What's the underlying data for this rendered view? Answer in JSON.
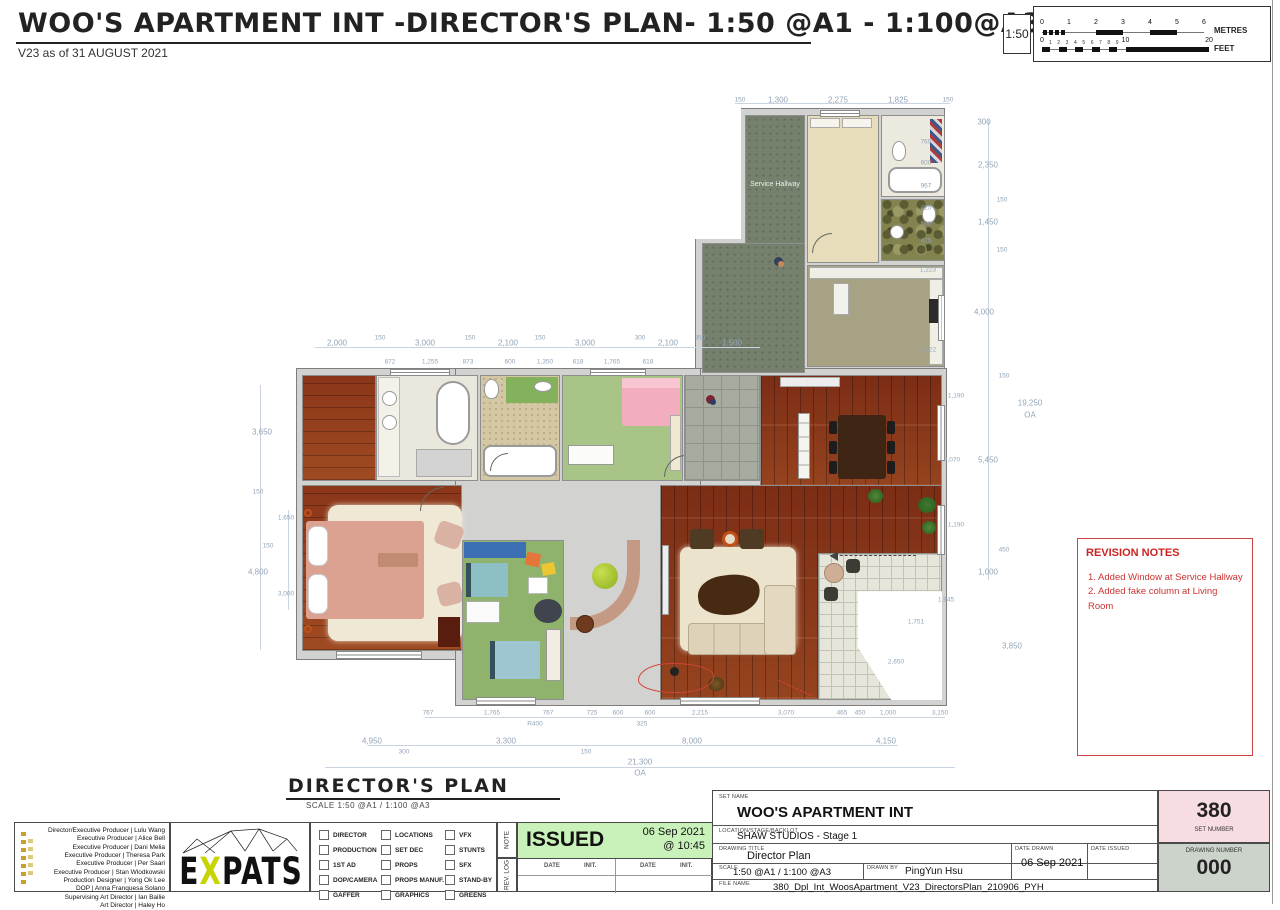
{
  "colors": {
    "revision_red": "#cc3333",
    "issued_green": "#c9f2ba",
    "set_number_pink": "#f7dce2",
    "drawing_number_gray": "#ccd3cb",
    "dim_blue": "#93a4b6",
    "wood_floor": "#7c2d15",
    "logo_x_green": "#c8d400"
  },
  "header": {
    "title": "WOO'S APARTMENT INT -DIRECTOR'S PLAN- 1:50 @A1 - 1:100@A3",
    "version": "V23 as of 31 AUGUST 2021"
  },
  "scalebar": {
    "ratio": "1:50",
    "metres_label": "METRES",
    "feet_label": "FEET",
    "metre_ticks": [
      "0",
      "1",
      "2",
      "3",
      "4",
      "5",
      "6"
    ],
    "feet_major_ticks": [
      "0",
      "10",
      "20"
    ],
    "feet_minor_ticks": [
      "1",
      "2",
      "3",
      "4",
      "5",
      "6",
      "7",
      "8",
      "9"
    ]
  },
  "plan": {
    "rooms": {
      "service_hallway": "Service Hallway"
    },
    "caption": {
      "title": "DIRECTOR'S PLAN",
      "scale_note": "SCALE 1:50 @A1 / 1:100 @A3"
    },
    "dim_labels": [
      [
        "150",
        500,
        15,
        1
      ],
      [
        "1,300",
        538,
        15,
        0
      ],
      [
        "2,275",
        598,
        15,
        0
      ],
      [
        "1,825",
        658,
        15,
        0
      ],
      [
        "150",
        708,
        15,
        1
      ],
      [
        "2,000",
        97,
        258,
        0
      ],
      [
        "150",
        140,
        253,
        1
      ],
      [
        "3,000",
        185,
        258,
        0
      ],
      [
        "150",
        230,
        253,
        1
      ],
      [
        "2,100",
        268,
        258,
        0
      ],
      [
        "150",
        300,
        253,
        1
      ],
      [
        "3,000",
        345,
        258,
        0
      ],
      [
        "300",
        400,
        253,
        1
      ],
      [
        "2,100",
        428,
        258,
        0
      ],
      [
        "350",
        460,
        253,
        1
      ],
      [
        "1,500",
        492,
        258,
        0
      ],
      [
        "872",
        150,
        277,
        1
      ],
      [
        "1,255",
        190,
        277,
        1
      ],
      [
        "873",
        228,
        277,
        1
      ],
      [
        "600",
        270,
        277,
        1
      ],
      [
        "1,350",
        305,
        277,
        1
      ],
      [
        "618",
        338,
        277,
        1
      ],
      [
        "1,765",
        372,
        277,
        1
      ],
      [
        "618",
        408,
        277,
        1
      ],
      [
        "3,650",
        22,
        347,
        0
      ],
      [
        "150",
        18,
        407,
        1
      ],
      [
        "1,650",
        46,
        433,
        1
      ],
      [
        "150",
        28,
        461,
        1
      ],
      [
        "4,800",
        18,
        487,
        0
      ],
      [
        "3,000",
        46,
        509,
        1
      ],
      [
        "300",
        744,
        37,
        0
      ],
      [
        "760",
        686,
        57,
        1
      ],
      [
        "600",
        686,
        78,
        1
      ],
      [
        "2,350",
        748,
        80,
        0
      ],
      [
        "967",
        686,
        101,
        1
      ],
      [
        "425",
        686,
        123,
        1
      ],
      [
        "150",
        762,
        115,
        1
      ],
      [
        "600",
        686,
        139,
        1
      ],
      [
        "1,450",
        748,
        137,
        0
      ],
      [
        "425",
        686,
        156,
        1
      ],
      [
        "150",
        762,
        165,
        1
      ],
      [
        "1,223",
        688,
        185,
        1
      ],
      [
        "4,000",
        744,
        227,
        0
      ],
      [
        "1,522",
        688,
        265,
        1
      ],
      [
        "150",
        764,
        291,
        1
      ],
      [
        "1,190",
        716,
        311,
        1
      ],
      [
        "19,250",
        790,
        318,
        0
      ],
      [
        "OA",
        790,
        330,
        0
      ],
      [
        "3,070",
        712,
        375,
        1
      ],
      [
        "5,450",
        748,
        375,
        0
      ],
      [
        "1,190",
        716,
        440,
        1
      ],
      [
        "450",
        764,
        465,
        1
      ],
      [
        "1,000",
        748,
        487,
        0
      ],
      [
        "1,945",
        706,
        515,
        1
      ],
      [
        "1,751",
        676,
        537,
        1
      ],
      [
        "3,850",
        772,
        561,
        0
      ],
      [
        "2,650",
        656,
        577,
        1
      ],
      [
        "767",
        188,
        628,
        1
      ],
      [
        "1,765",
        252,
        628,
        1
      ],
      [
        "767",
        308,
        628,
        1
      ],
      [
        "R400",
        295,
        639,
        1
      ],
      [
        "725",
        352,
        628,
        1
      ],
      [
        "600",
        378,
        628,
        1
      ],
      [
        "600",
        410,
        628,
        1
      ],
      [
        "325",
        402,
        639,
        1
      ],
      [
        "2,215",
        460,
        628,
        1
      ],
      [
        "3,070",
        546,
        628,
        1
      ],
      [
        "465",
        602,
        628,
        1
      ],
      [
        "450",
        620,
        628,
        1
      ],
      [
        "1,000",
        648,
        628,
        1
      ],
      [
        "3,150",
        700,
        628,
        1
      ],
      [
        "4,950",
        132,
        656,
        0
      ],
      [
        "300",
        164,
        667,
        1
      ],
      [
        "3,300",
        266,
        656,
        0
      ],
      [
        "150",
        346,
        667,
        1
      ],
      [
        "8,000",
        452,
        656,
        0
      ],
      [
        "4,150",
        646,
        656,
        0
      ],
      [
        "21,300",
        400,
        677,
        0
      ],
      [
        "OA",
        400,
        688,
        0
      ]
    ]
  },
  "revision_notes": {
    "title": "REVISION NOTES",
    "items": [
      "1. Added Window at Service Hallway",
      "2. Added fake column at Living Room"
    ]
  },
  "credits": [
    "Director/Executive Producer | Lulu Wang",
    "Executive Producer | Alice Bell",
    "Executive Producer | Dani Melia",
    "Executive Producer | Theresa Park",
    "Executive Producer | Per Saari",
    "Executive Producer | Stan Wlodkowski",
    "Production Designer | Yong Ok Lee",
    "DOP | Anna Franquesa Solano",
    "Supervising Art Director | Ian Bailie",
    "Art Director | Haley Ho"
  ],
  "logo": {
    "letters": [
      "E",
      "X",
      "P",
      "A",
      "T",
      "S"
    ],
    "highlight_index": 1
  },
  "departments": {
    "columns": [
      [
        "DIRECTOR",
        "PRODUCTION",
        "1ST AD",
        "DOP/CAMERA",
        "GAFFER"
      ],
      [
        "LOCATIONS",
        "SET DEC",
        "PROPS",
        "PROPS MANUF.",
        "GRAPHICS"
      ],
      [
        "VFX",
        "STUNTS",
        "SFX",
        "STAND-BY",
        "GREENS"
      ]
    ]
  },
  "issue_log": {
    "side_note": "NOTE",
    "side_rev": "REV. LOG",
    "status": "ISSUED",
    "date": "06 Sep 2021",
    "time": "@ 10:45",
    "date_header": "DATE",
    "init_header": "INIT."
  },
  "titleblock": {
    "labels": {
      "set_name": "SET NAME",
      "location": "LOCATION/STAGE/BACKLOT",
      "drawing_title": "DRAWING TITLE",
      "scale": "SCALE",
      "drawn_by": "DRAWN BY",
      "date_drawn": "DATE DRAWN",
      "date_issued": "DATE ISSUED",
      "file_name": "FILE NAME",
      "set_number": "SET NUMBER",
      "drawing_number": "DRAWING NUMBER"
    },
    "values": {
      "set_name": "WOO'S APARTMENT INT",
      "location": "SHAW STUDIOS - Stage 1",
      "drawing_title": "Director Plan",
      "scale": "1:50 @A1 / 1:100 @A3",
      "drawn_by": "PingYun Hsu",
      "date_drawn": "06 Sep 2021",
      "date_issued": "",
      "file_name": "380_Dpl_Int_WoosApartment_V23_DirectorsPlan_210906_PYH",
      "set_number": "380",
      "drawing_number": "000"
    }
  }
}
